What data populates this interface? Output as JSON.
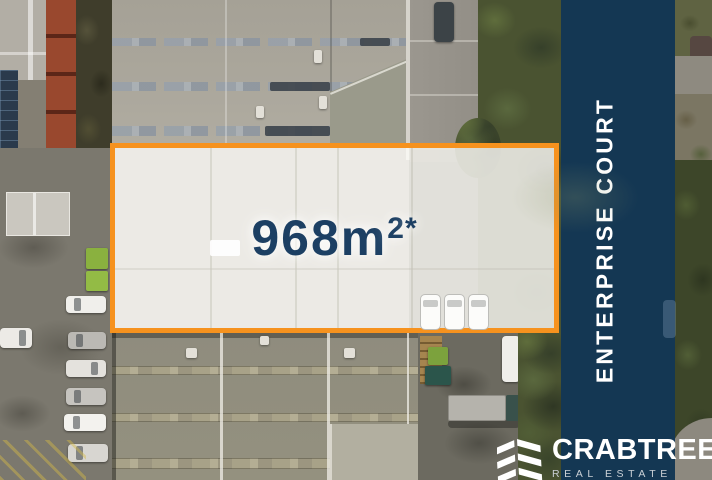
{
  "overlay": {
    "area": {
      "value": "968m",
      "superscript": "2",
      "asterisk": "*",
      "full_label": "968m²*"
    },
    "street_name": "ENTERPRISE COURT"
  },
  "brand": {
    "name": "CRABTREES",
    "tagline": "REAL ESTATE",
    "logo_icon": "stacked-chevrons-icon"
  },
  "colors": {
    "accent_orange": "#F6921E",
    "street_band_navy": "#0D3352",
    "area_text_navy": "#1C3F63",
    "text_white": "#FFFFFF",
    "tagline_gray": "#C9CFD5"
  }
}
